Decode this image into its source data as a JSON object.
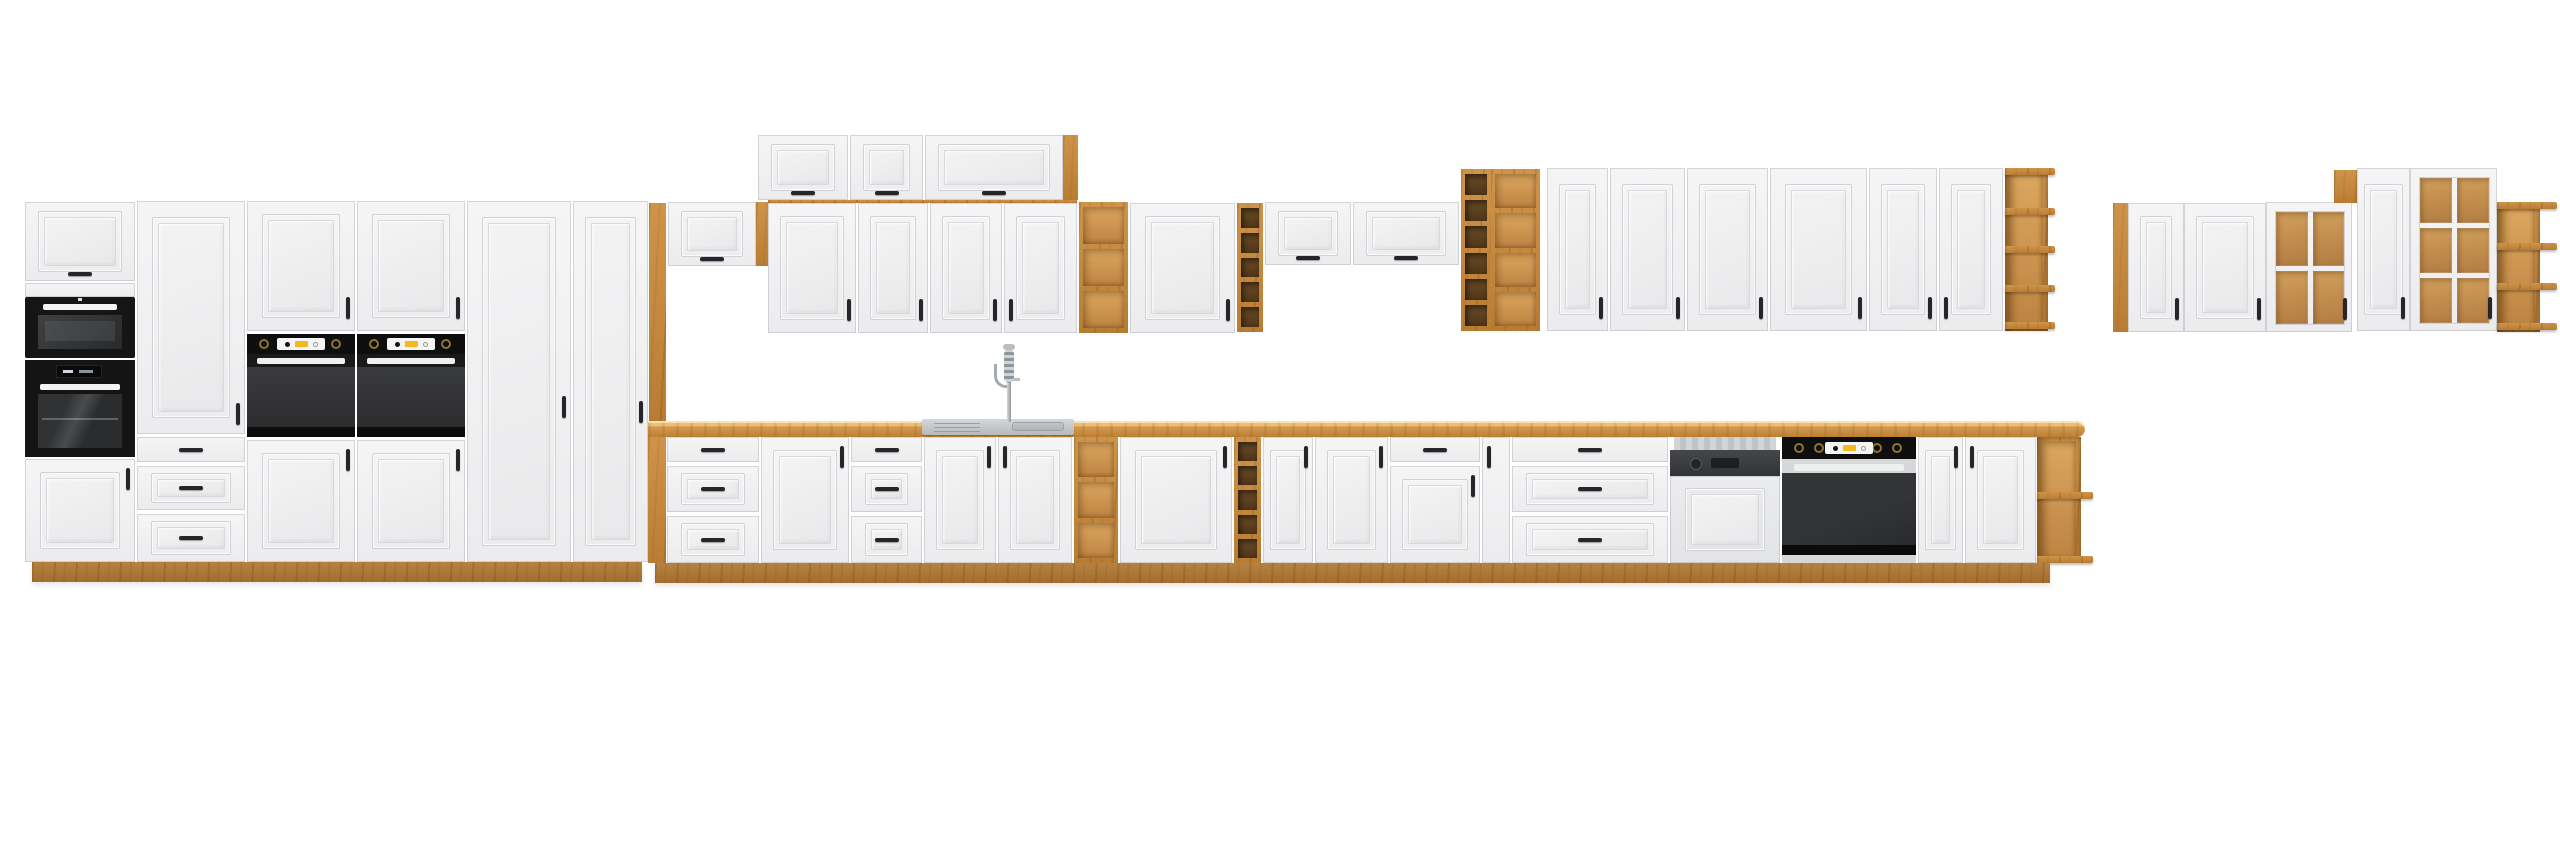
{
  "image": {
    "kind": "product-render",
    "subject": "modular-kitchen-cabinet-set",
    "background": "#ffffff",
    "canvas": {
      "w": 2560,
      "h": 848
    }
  },
  "palette": {
    "front": "#f1f1f2",
    "front_shadow": "#d7d7da",
    "oak": "#c58940",
    "oak_light": "#dca75f",
    "oak_dark": "#a06a2a",
    "countertop": "#d79b4e",
    "appliance_black": "#141414",
    "oven_door_gray": "#323335",
    "stainless": "#c7cacc",
    "display_yellow": "#f3b81d",
    "handle": "#26262a"
  },
  "scene": {
    "units": [
      {
        "n": "tall-cab1-flap-door",
        "k": "flap",
        "b": [
          25,
          202,
          110,
          79
        ]
      },
      {
        "n": "tall-cab1-filler",
        "k": "filler",
        "b": [
          25,
          283,
          110,
          14
        ]
      },
      {
        "n": "microwave",
        "k": "microwave",
        "b": [
          25,
          297,
          110,
          61
        ]
      },
      {
        "n": "compact-oven",
        "k": "steamoven",
        "b": [
          25,
          360,
          110,
          97
        ]
      },
      {
        "n": "tall-cab1-lower-door",
        "k": "door",
        "b": [
          25,
          459,
          110,
          103
        ],
        "h": "rt"
      },
      {
        "n": "tall-cab2-door",
        "k": "door",
        "b": [
          137,
          201,
          108,
          233
        ],
        "h": "rw",
        "ht": 202
      },
      {
        "n": "tall-cab2-drawer-1",
        "k": "drawer",
        "b": [
          137,
          437,
          108,
          25
        ],
        "plain": true
      },
      {
        "n": "tall-cab2-drawer-2",
        "k": "drawer",
        "b": [
          137,
          466,
          108,
          44
        ]
      },
      {
        "n": "tall-cab2-drawer-3",
        "k": "drawer",
        "b": [
          137,
          514,
          108,
          48
        ]
      },
      {
        "n": "oven-column-1-upper-door",
        "k": "door",
        "b": [
          247,
          201,
          108,
          130
        ],
        "h": "rb"
      },
      {
        "n": "oven-column-1-oven",
        "k": "ovenstack",
        "b": [
          247,
          334,
          108,
          103
        ]
      },
      {
        "n": "oven-column-1-lower-door",
        "k": "door",
        "b": [
          247,
          440,
          108,
          122
        ],
        "h": "rt"
      },
      {
        "n": "oven-column-2-upper-door",
        "k": "door",
        "b": [
          357,
          201,
          108,
          130
        ],
        "h": "rb"
      },
      {
        "n": "oven-column-2-oven",
        "k": "ovenstack",
        "b": [
          357,
          334,
          108,
          103
        ]
      },
      {
        "n": "oven-column-2-lower-door",
        "k": "door",
        "b": [
          357,
          440,
          108,
          122
        ],
        "h": "rt"
      },
      {
        "n": "pantry-door-1",
        "k": "door",
        "b": [
          467,
          201,
          104,
          361
        ],
        "h": "rw",
        "ht": 195
      },
      {
        "n": "pantry-door-2",
        "k": "door",
        "b": [
          573,
          201,
          75,
          361
        ],
        "h": "rw",
        "ht": 200
      },
      {
        "n": "tall-section-plinth",
        "k": "plinth",
        "b": [
          32,
          562,
          610,
          20
        ]
      },
      {
        "n": "oak-upright-left",
        "k": "oak",
        "b": [
          649,
          203,
          17,
          218
        ]
      },
      {
        "n": "wall-flap-over-counter",
        "k": "flap",
        "b": [
          668,
          202,
          88,
          64
        ]
      },
      {
        "n": "oak-upright-right",
        "k": "oak",
        "b": [
          756,
          202,
          12,
          64
        ]
      },
      {
        "n": "wall-top-flap-1",
        "k": "flap",
        "b": [
          758,
          135,
          90,
          65
        ]
      },
      {
        "n": "wall-top-flap-2",
        "k": "flap",
        "b": [
          850,
          135,
          73,
          65
        ]
      },
      {
        "n": "wall-top-flap-3",
        "k": "flap",
        "b": [
          925,
          135,
          138,
          65
        ]
      },
      {
        "n": "wall-top-oak-end",
        "k": "oak",
        "b": [
          1063,
          135,
          15,
          65
        ]
      },
      {
        "n": "wall-a-oak-top-edge",
        "k": "oak",
        "b": [
          768,
          200,
          309,
          3
        ]
      },
      {
        "n": "wall-a-door-1",
        "k": "door",
        "b": [
          768,
          203,
          88,
          130
        ],
        "h": "rb"
      },
      {
        "n": "wall-a-door-2",
        "k": "door",
        "b": [
          858,
          203,
          70,
          130
        ],
        "h": "rb"
      },
      {
        "n": "wall-a-door-3",
        "k": "door",
        "b": [
          930,
          203,
          72,
          130
        ],
        "h": "rb"
      },
      {
        "n": "wall-a-door-4",
        "k": "door",
        "b": [
          1004,
          203,
          73,
          130
        ],
        "h": "lb"
      },
      {
        "n": "wall-oak-shelf",
        "k": "oakshelf",
        "b": [
          1079,
          202,
          49,
          131
        ],
        "rows": 3,
        "int": "L"
      },
      {
        "n": "wall-a-door-5",
        "k": "door",
        "b": [
          1130,
          203,
          105,
          130
        ],
        "h": "rb"
      },
      {
        "n": "wall-oak-column",
        "k": "oakshelf",
        "b": [
          1237,
          203,
          26,
          129
        ],
        "rows": 5,
        "int": "D"
      },
      {
        "n": "wall-flap-1",
        "k": "flap",
        "b": [
          1265,
          202,
          86,
          63
        ]
      },
      {
        "n": "wall-flap-2",
        "k": "flap",
        "b": [
          1353,
          202,
          106,
          63
        ]
      },
      {
        "n": "wall-oak-rack",
        "k": "oakshelf",
        "b": [
          1461,
          169,
          30,
          162
        ],
        "rows": 6,
        "int": "D"
      },
      {
        "n": "wall-oak-open-shelf",
        "k": "oakshelf",
        "b": [
          1491,
          169,
          49,
          162
        ],
        "rows": 4,
        "int": "L"
      },
      {
        "n": "wall-b-door-1",
        "k": "door",
        "b": [
          1547,
          168,
          61,
          163
        ],
        "h": "rb"
      },
      {
        "n": "wall-b-door-2",
        "k": "door",
        "b": [
          1610,
          168,
          75,
          163
        ],
        "h": "rb"
      },
      {
        "n": "wall-b-door-3",
        "k": "door",
        "b": [
          1687,
          168,
          81,
          163
        ],
        "h": "rb"
      },
      {
        "n": "wall-b-door-4",
        "k": "door",
        "b": [
          1770,
          168,
          97,
          163
        ],
        "h": "rb"
      },
      {
        "n": "wall-b-door-5",
        "k": "door",
        "b": [
          1869,
          168,
          68,
          163
        ],
        "h": "rb"
      },
      {
        "n": "wall-b-door-6",
        "k": "door",
        "b": [
          1939,
          168,
          64,
          163
        ],
        "h": "lb"
      },
      {
        "n": "wall-b-oak-end-shelf",
        "k": "oaktier",
        "b": [
          2005,
          168,
          50,
          163
        ],
        "bw": 43,
        "boards": [
          0,
          40,
          78,
          117,
          154
        ]
      },
      {
        "n": "right-group-a-oak-side",
        "k": "oak",
        "b": [
          2113,
          203,
          15,
          129
        ]
      },
      {
        "n": "right-group-a-door-1",
        "k": "door",
        "b": [
          2128,
          203,
          56,
          129
        ],
        "h": "rb"
      },
      {
        "n": "right-group-a-door-2",
        "k": "door",
        "b": [
          2184,
          203,
          82,
          129
        ],
        "h": "rb"
      },
      {
        "n": "right-group-a-glass-door",
        "k": "glass",
        "b": [
          2266,
          202,
          86,
          130
        ],
        "rows": 2
      },
      {
        "n": "right-group-b-oak-block",
        "k": "oak",
        "b": [
          2334,
          170,
          23,
          33
        ]
      },
      {
        "n": "right-group-b-door",
        "k": "door",
        "b": [
          2357,
          168,
          53,
          163
        ],
        "h": "rb"
      },
      {
        "n": "right-group-b-glass-door",
        "k": "glass",
        "b": [
          2410,
          168,
          87,
          163
        ],
        "rows": 3
      },
      {
        "n": "right-group-b-oak-end-shelf",
        "k": "oaktier",
        "b": [
          2497,
          202,
          60,
          130
        ],
        "bw": 43,
        "boards": [
          0,
          41,
          81,
          121
        ]
      },
      {
        "n": "countertop",
        "k": "counter",
        "b": [
          648,
          421,
          1437,
          16
        ]
      },
      {
        "n": "sink",
        "k": "sink",
        "b": [
          922,
          419,
          152,
          16
        ]
      },
      {
        "n": "faucet",
        "k": "faucet",
        "b": [
          994,
          344,
          26,
          78
        ]
      },
      {
        "n": "base-oak-side",
        "k": "oak",
        "b": [
          648,
          437,
          18,
          126
        ]
      },
      {
        "n": "base-drawer-cab-1",
        "k": "drawers3",
        "b": [
          667,
          437,
          92,
          126
        ]
      },
      {
        "n": "base-door-1",
        "k": "door",
        "b": [
          761,
          437,
          88,
          126
        ],
        "h": "rt"
      },
      {
        "n": "base-drawer-cab-2",
        "k": "drawers3",
        "b": [
          851,
          437,
          71,
          126
        ]
      },
      {
        "n": "sink-door-left",
        "k": "door",
        "b": [
          924,
          437,
          72,
          126
        ],
        "h": "rt"
      },
      {
        "n": "sink-door-right",
        "k": "door",
        "b": [
          998,
          437,
          74,
          126
        ],
        "h": "lt"
      },
      {
        "n": "base-oak-shelf",
        "k": "oakshelf",
        "b": [
          1074,
          437,
          44,
          126
        ],
        "rows": 3,
        "int": "L"
      },
      {
        "n": "base-door-2",
        "k": "door",
        "b": [
          1120,
          437,
          112,
          126
        ],
        "h": "rt"
      },
      {
        "n": "base-oak-column",
        "k": "oakshelf",
        "b": [
          1234,
          437,
          27,
          126
        ],
        "rows": 5,
        "int": "D"
      },
      {
        "n": "base-door-3",
        "k": "door",
        "b": [
          1263,
          437,
          50,
          126
        ],
        "h": "rt"
      },
      {
        "n": "base-door-4",
        "k": "door",
        "b": [
          1315,
          437,
          73,
          126
        ],
        "h": "rt"
      },
      {
        "n": "base-drawer-door-cab",
        "k": "drawerdoor",
        "b": [
          1390,
          437,
          90,
          126
        ]
      },
      {
        "n": "base-filler-door",
        "k": "door",
        "b": [
          1482,
          437,
          28,
          126
        ],
        "plain": true,
        "h": "lt"
      },
      {
        "n": "base-drawer-cab-3",
        "k": "drawers3",
        "b": [
          1512,
          437,
          156,
          126
        ]
      },
      {
        "n": "dishwasher",
        "k": "dishwasher",
        "b": [
          1670,
          437,
          110,
          126
        ]
      },
      {
        "n": "built-in-oven",
        "k": "oven",
        "b": [
          1782,
          437,
          134,
          126
        ]
      },
      {
        "n": "base-door-5",
        "k": "door",
        "b": [
          1918,
          437,
          45,
          126
        ],
        "h": "rt"
      },
      {
        "n": "base-door-6",
        "k": "door",
        "b": [
          1965,
          437,
          71,
          126
        ],
        "h": "lt"
      },
      {
        "n": "base-oak-end-shelf",
        "k": "oaktier",
        "b": [
          2037,
          437,
          56,
          126
        ],
        "bw": 44,
        "boards": [
          55,
          119
        ]
      },
      {
        "n": "base-plinth",
        "k": "plinth",
        "b": [
          655,
          563,
          1395,
          20
        ]
      }
    ]
  }
}
